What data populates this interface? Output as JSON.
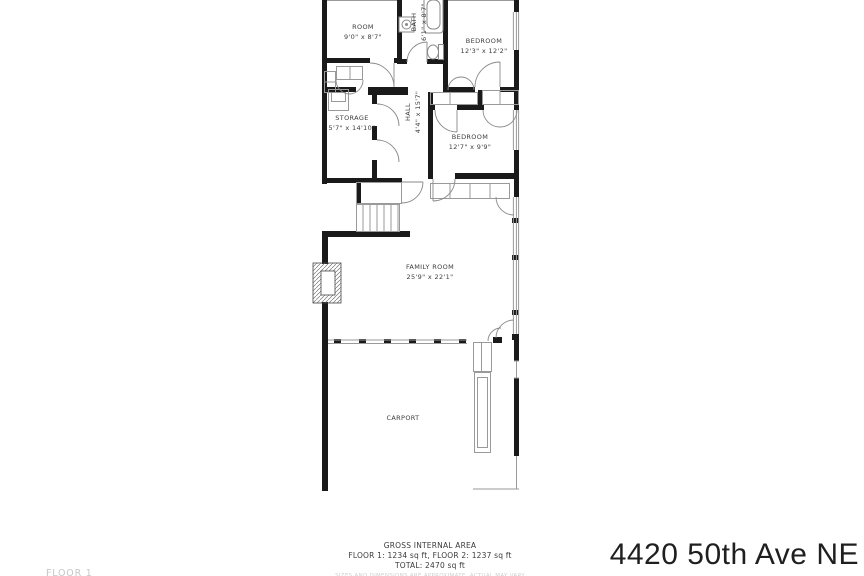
{
  "title": "4420 50th Ave NE",
  "floor_label": "FLOOR 1",
  "rooms": [
    {
      "name": "ROOM",
      "dims": "9'0\" x 8'7\""
    },
    {
      "name": "BATH",
      "dims": "6'1\" x 8'7\""
    },
    {
      "name": "BEDROOM",
      "dims": "12'3\" x 12'2\""
    },
    {
      "name": "STORAGE",
      "dims": "5'7\" x 14'10\""
    },
    {
      "name": "HALL",
      "dims": "4'4\" x 15'7\""
    },
    {
      "name": "BEDROOM",
      "dims": "12'7\" x 9'9\""
    },
    {
      "name": "FAMILY ROOM",
      "dims": "25'9\" x 22'1\""
    },
    {
      "name": "CARPORT",
      "dims": ""
    }
  ],
  "footer": {
    "heading": "GROSS INTERNAL AREA",
    "floors": "FLOOR 1: 1234 sq ft, FLOOR 2: 1237 sq ft",
    "total": "TOTAL: 2470 sq ft",
    "disclaimer": "SIZES AND DIMENSIONS ARE APPROXIMATE, ACTUAL MAY VARY"
  },
  "colors": {
    "wall": "#1a1a1a",
    "line": "#9a9a9a",
    "text": "#3c3c3c",
    "muted": "#c6c6c6"
  }
}
